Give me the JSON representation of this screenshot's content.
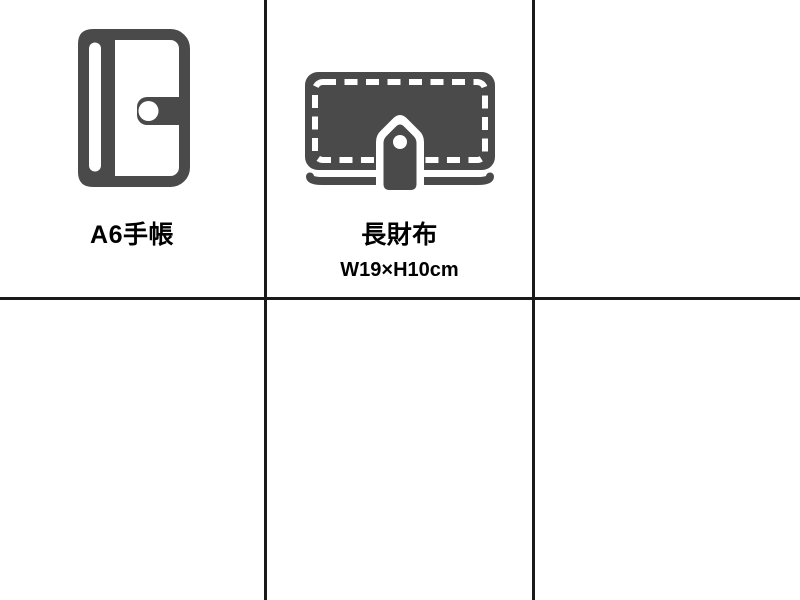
{
  "page": {
    "background": "#ffffff"
  },
  "grid": {
    "columns": 3,
    "rows": 2,
    "line_color": "#1a1a1a"
  },
  "colors": {
    "icon_gray": "#4a4a4a",
    "label_text": "#000000",
    "background": "#ffffff",
    "grid_line": "#1a1a1a"
  },
  "cells": [
    {
      "icon": "notebook-icon",
      "label": "A6手帳"
    },
    {
      "icon": "wallet-icon",
      "label": "長財布",
      "size": "W19×H10cm"
    },
    {},
    {},
    {},
    {}
  ]
}
